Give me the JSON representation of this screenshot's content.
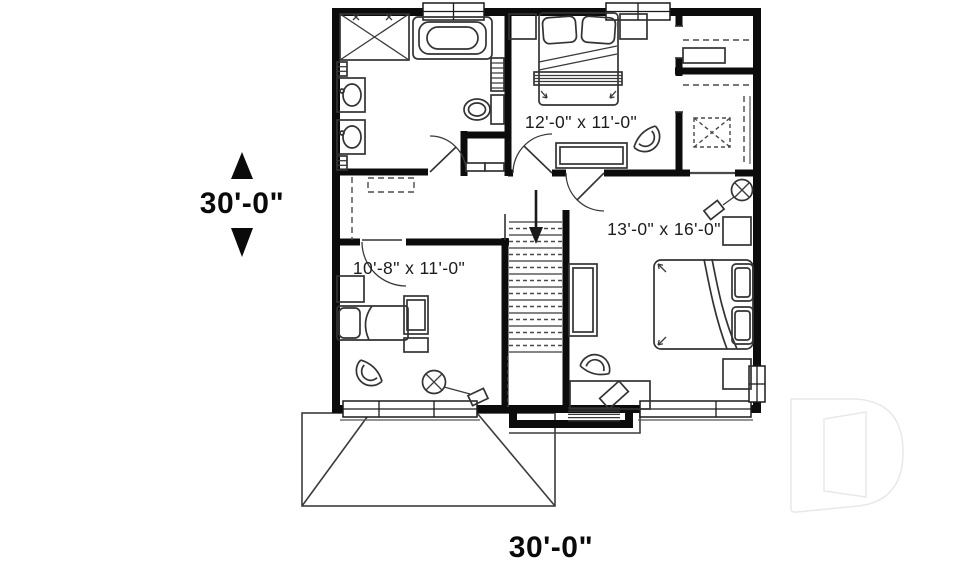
{
  "plan": {
    "overall_dimensions": {
      "depth_label": "30'-0\"",
      "width_label": "30'-0\""
    },
    "rooms": [
      {
        "id": "bedroom-top",
        "size_label": "12'-0\" x 11'-0\""
      },
      {
        "id": "bedroom-right",
        "size_label": "13'-0\" x 16'-0\""
      },
      {
        "id": "bedroom-left",
        "size_label": "10'-8\" x 11'-0\""
      }
    ],
    "watermark_logo": "stylized-letter-D",
    "colors": {
      "background": "#ffffff",
      "walls": "#0c0c0c",
      "furniture_lines": "#3a3a3a",
      "watermark_outline": "#e8e8e8"
    }
  }
}
